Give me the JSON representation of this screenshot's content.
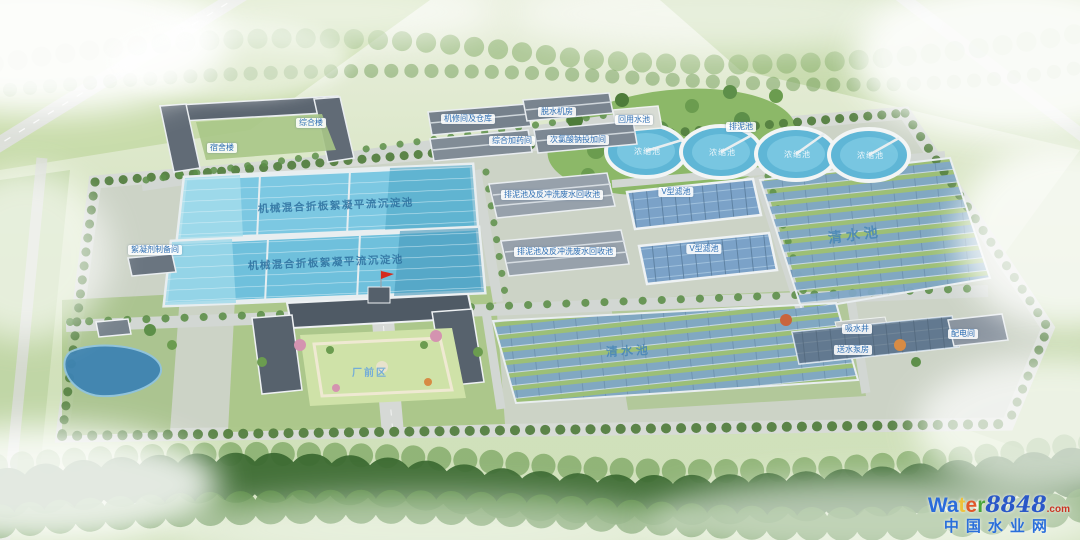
{
  "chips": [
    {
      "text": "宿舍楼"
    },
    {
      "text": "综合楼"
    },
    {
      "text": "机修间及仓库"
    },
    {
      "text": "脱水机房"
    },
    {
      "text": "综合加药间"
    },
    {
      "text": "次氯酸钠投加间"
    },
    {
      "text": "絮凝剂制备间"
    },
    {
      "text": "回用水池"
    },
    {
      "text": "排泥池"
    },
    {
      "text": "排泥池及反冲洗废水回收池"
    },
    {
      "text": "排泥池及反冲洗废水回收池"
    },
    {
      "text": "V型滤池"
    },
    {
      "text": "V型滤池"
    },
    {
      "text": "吸水井"
    },
    {
      "text": "送水泵房"
    },
    {
      "text": "配电间"
    }
  ],
  "water_texts": {
    "basin": "机械混合折板絮凝平流沉淀池",
    "clearwater": "清水池",
    "thickener": "浓缩池",
    "front_area": "厂前区"
  },
  "watermark": {
    "letters": [
      {
        "ch": "W",
        "color": "#2a6bdb"
      },
      {
        "ch": "a",
        "color": "#2a6bdb"
      },
      {
        "ch": "t",
        "color": "#eec23a"
      },
      {
        "ch": "e",
        "color": "#e2582a"
      },
      {
        "ch": "r",
        "color": "#49a53c"
      }
    ],
    "number": "8848",
    "number_color": "#2a58c8",
    "domain": ".com",
    "domain_color": "#cc3322",
    "line2": "中国水业网",
    "line2_color": "#2a6fdb"
  },
  "colors": {
    "basin_water": "#7cc8e2",
    "solar_panel": "#7fa6c6",
    "lawn": "#9cc27a",
    "roof_dark": "#4f5a65",
    "road": "#d2d7d3"
  }
}
